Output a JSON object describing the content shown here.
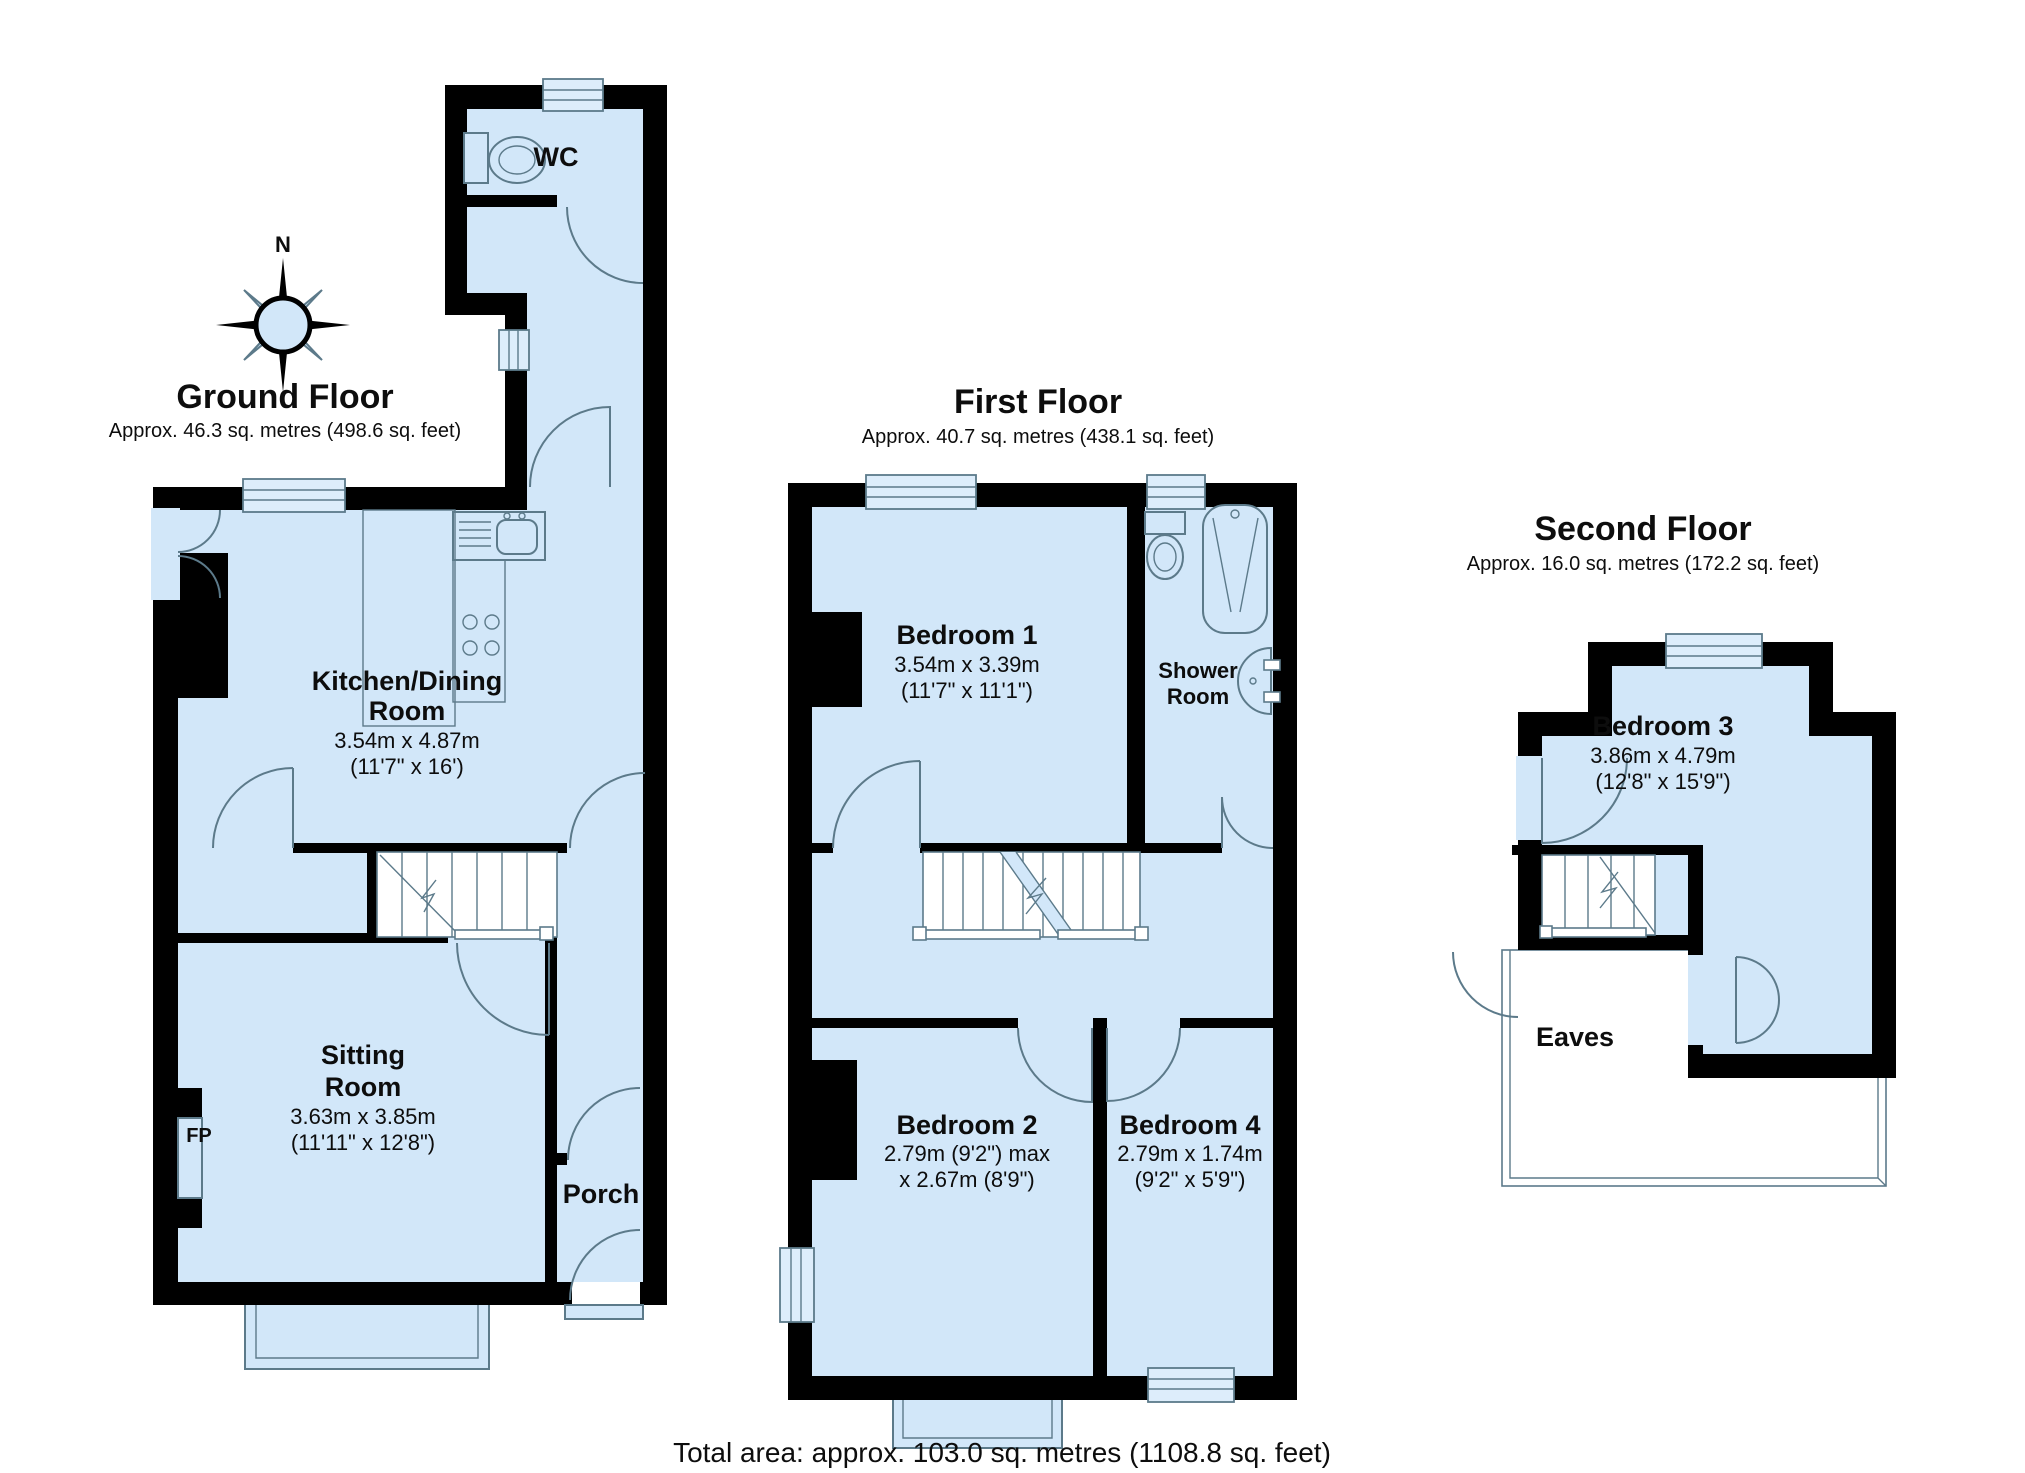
{
  "document": {
    "background": "#ffffff"
  },
  "footer": {
    "total_area": "Total area: approx. 103.0 sq. metres (1108.8 sq. feet)"
  },
  "compass": {
    "north_label": "N"
  },
  "ground_floor": {
    "title": "Ground Floor",
    "area": "Approx. 46.3 sq. metres (498.6 sq. feet)",
    "wc_label": "WC",
    "porch_label": "Porch",
    "fireplace_label": "FP",
    "kitchen_dining": {
      "name_line1": "Kitchen/Dining",
      "name_line2": "Room",
      "size_metric": "3.54m x 4.87m",
      "size_imperial": "(11'7\" x 16')"
    },
    "sitting_room": {
      "name_line1": "Sitting",
      "name_line2": "Room",
      "size_metric": "3.63m x 3.85m",
      "size_imperial": "(11'11\" x 12'8\")"
    }
  },
  "first_floor": {
    "title": "First Floor",
    "area": "Approx. 40.7 sq. metres (438.1 sq. feet)",
    "bedroom1": {
      "name": "Bedroom 1",
      "size_metric": "3.54m x 3.39m",
      "size_imperial": "(11'7\" x 11'1\")"
    },
    "shower_room": {
      "name_line1": "Shower",
      "name_line2": "Room"
    },
    "bedroom2": {
      "name": "Bedroom 2",
      "size_line1": "2.79m (9'2\") max",
      "size_line2": "x 2.67m (8'9\")"
    },
    "bedroom4": {
      "name": "Bedroom 4",
      "size_metric": "2.79m x 1.74m",
      "size_imperial": "(9'2\" x 5'9\")"
    }
  },
  "second_floor": {
    "title": "Second Floor",
    "area": "Approx. 16.0 sq. metres (172.2 sq. feet)",
    "bedroom3": {
      "name": "Bedroom 3",
      "size_metric": "3.86m x 4.79m",
      "size_imperial": "(12'8\" x 15'9\")"
    },
    "eaves_label": "Eaves"
  },
  "colors": {
    "floor_fill": "#d2e7f9",
    "wall": "#000000",
    "detail_line": "#5c7a8a"
  }
}
